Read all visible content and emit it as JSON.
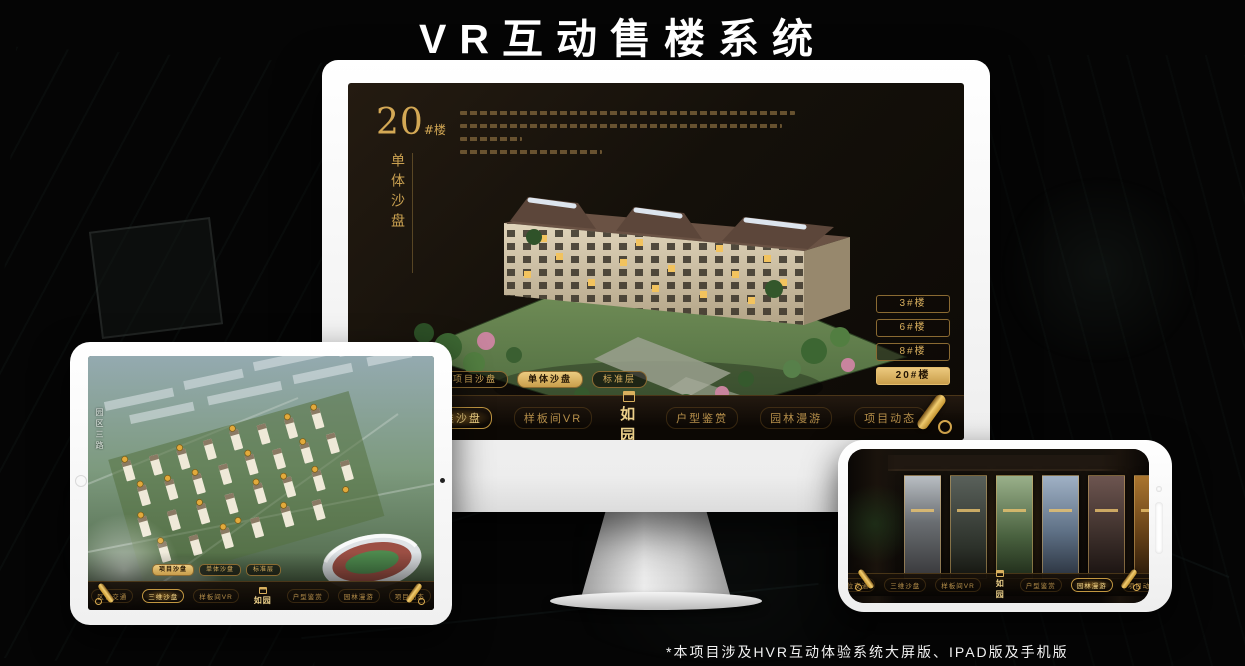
{
  "page": {
    "title": "VR互动售楼系统",
    "footnote": "*本项目涉及HVR互动体验系统大屏版、IPAD版及手机版"
  },
  "colors": {
    "gold": "#d9b05e",
    "gold_deep": "#b98d3c",
    "screen_bg": "#14100a"
  },
  "nav": {
    "logo": "如园",
    "items": [
      "区位交通",
      "三维沙盘",
      "样板间VR",
      "户型鉴赏",
      "园林漫游",
      "项目动态"
    ]
  },
  "monitor": {
    "building_number": "20",
    "building_number_suffix": "#楼",
    "subtitle": "单体沙盘",
    "floor_buttons": [
      "3#楼",
      "6#楼",
      "8#楼",
      "20#楼"
    ],
    "active_floor": "20#楼",
    "view_tabs": [
      "项目沙盘",
      "单体沙盘",
      "标准层"
    ],
    "active_view_tab": "单体沙盘",
    "active_nav": "三维沙盘"
  },
  "ipad": {
    "road_label": "园区三路",
    "view_tabs": [
      "项目沙盘",
      "单体沙盘",
      "标准层"
    ],
    "active_view_tab": "项目沙盘",
    "active_nav": "三维沙盘"
  },
  "phone": {
    "active_nav": "园林漫游"
  }
}
